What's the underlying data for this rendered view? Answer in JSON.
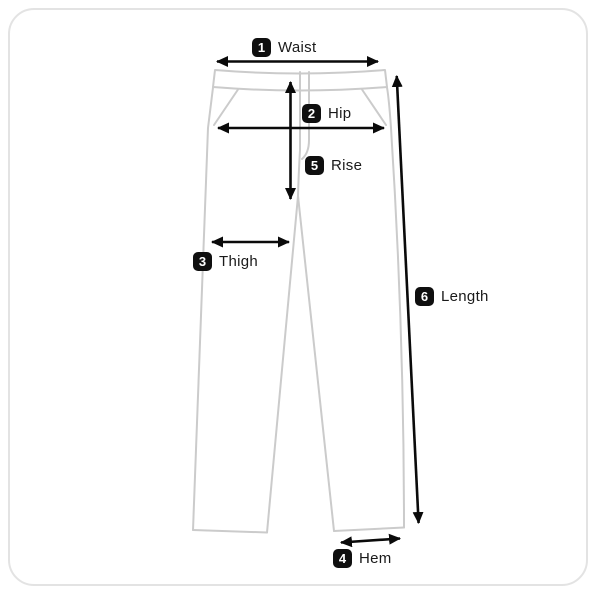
{
  "diagram": {
    "labels": [
      {
        "num": "1",
        "text": "Waist"
      },
      {
        "num": "2",
        "text": "Hip"
      },
      {
        "num": "3",
        "text": "Thigh"
      },
      {
        "num": "4",
        "text": "Hem"
      },
      {
        "num": "5",
        "text": "Rise"
      },
      {
        "num": "6",
        "text": "Length"
      }
    ],
    "colors": {
      "garment_outline": "#cbcbcb",
      "arrow": "#0a0a0a",
      "badge_background": "#0f0f0f",
      "badge_text": "#ffffff",
      "card_border": "#e3e3e3",
      "background": "#ffffff"
    }
  }
}
